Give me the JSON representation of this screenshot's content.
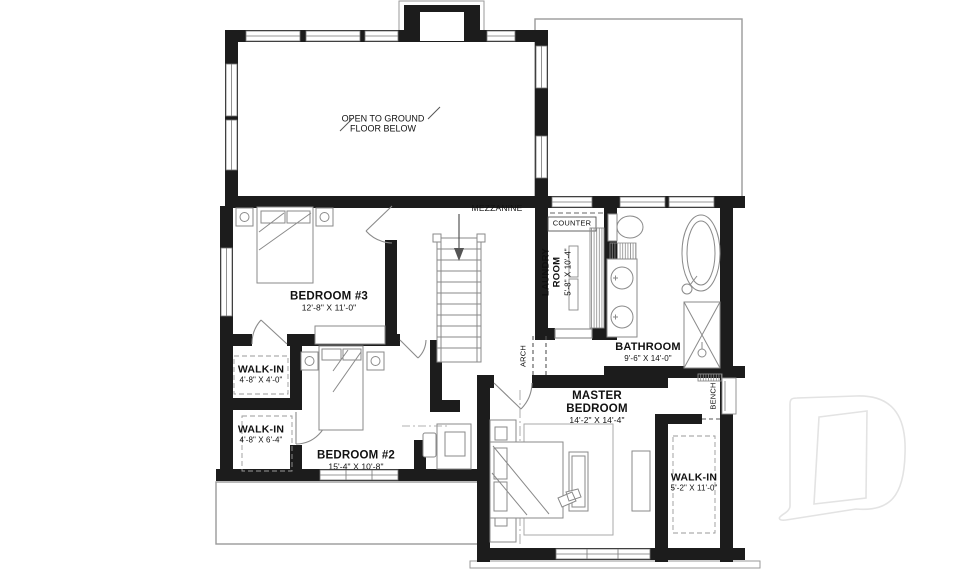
{
  "plan": {
    "open_area": {
      "line1": "OPEN TO GROUND",
      "line2": "FLOOR BELOW"
    },
    "mezzanine": "MEZZANINE",
    "counter": "COUNTER",
    "arch": "ARCH",
    "bench": "BENCH",
    "rooms": {
      "laundry": {
        "name_line1": "LAUNDRY",
        "name_line2": "ROOM",
        "dims": "5'-8\" X 10'-4\""
      },
      "bathroom": {
        "name": "BATHROOM",
        "dims": "9'-6\" X 14'-0\""
      },
      "bedroom3": {
        "name": "BEDROOM #3",
        "dims": "12'-8\" X 11'-0\""
      },
      "bedroom2": {
        "name": "BEDROOM #2",
        "dims": "15'-4\" X 10'-8\""
      },
      "master": {
        "name_line1": "MASTER",
        "name_line2": "BEDROOM",
        "dims": "14'-2\" X 14'-4\""
      },
      "walkin_a": {
        "name": "WALK-IN",
        "dims": "4'-8\" X 4'-0\""
      },
      "walkin_b": {
        "name": "WALK-IN",
        "dims": "4'-8\" X 6'-4\""
      },
      "walkin_master": {
        "name": "WALK-IN",
        "dims": "5'-2\" X 11'-0\""
      }
    },
    "watermark_letter": "D",
    "colors": {
      "wall": "#1c1c1c",
      "furniture": "#8a8a8a",
      "watermark": "#e3e3e3"
    }
  }
}
